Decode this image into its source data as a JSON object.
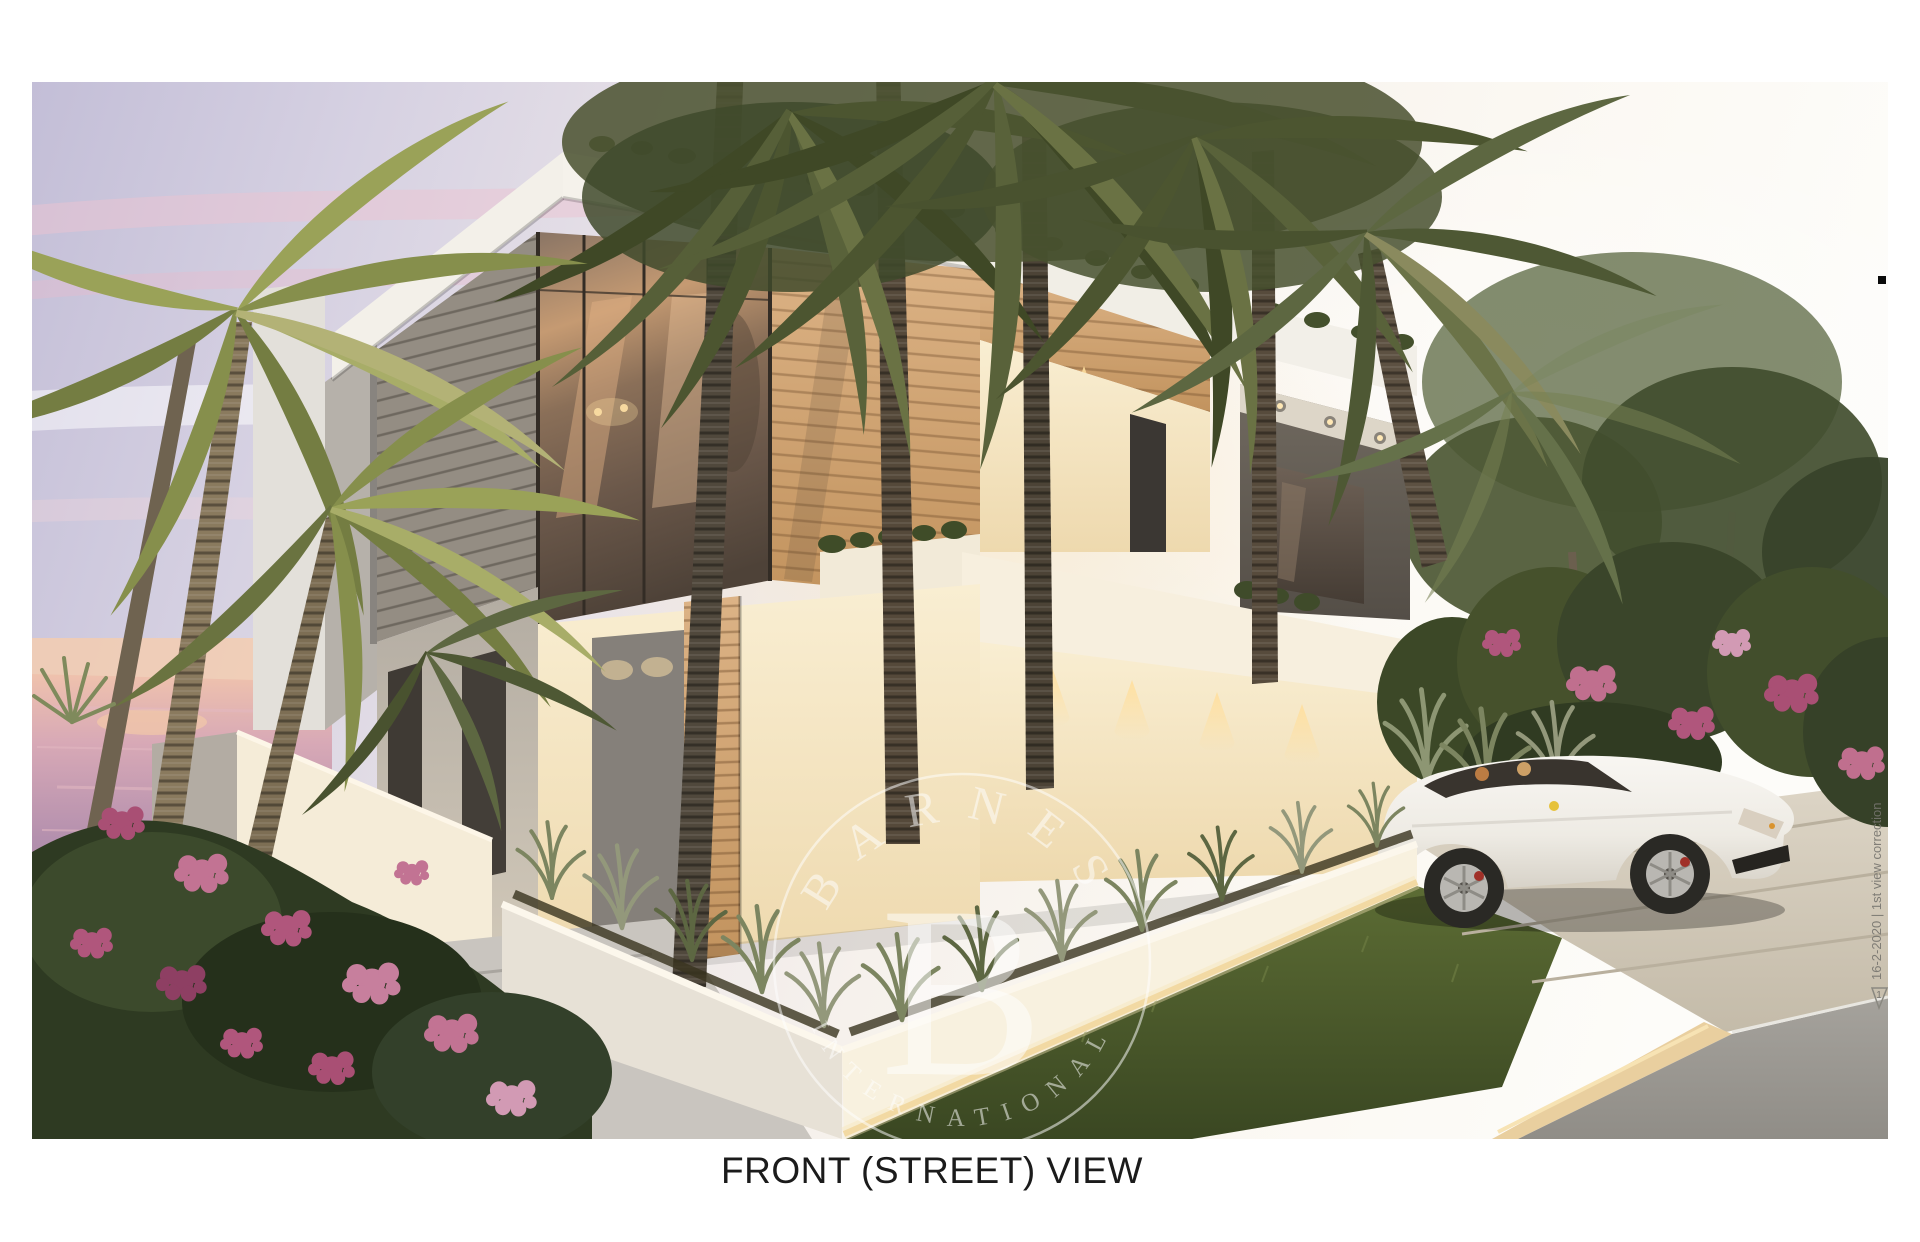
{
  "caption": {
    "text": "FRONT (STREET) VIEW"
  },
  "watermark": {
    "arc_top": "BARNES",
    "initial": "B",
    "arc_bottom": "INTERNATIONAL",
    "color": "#ffffff"
  },
  "revision_note": {
    "text": "16-2-2020 | 1st view correction",
    "marker": "1"
  },
  "palette": {
    "sky_lavender": "#c3bed7",
    "sky_pink": "#ecc3d2",
    "sky_cream": "#fbf8f2",
    "sea_mauve": "#b490ae",
    "horizon_glow": "#f3cdb0",
    "wall_cream": "#f6e9cc",
    "wood_cladding": "#d2a877",
    "foliage_dark": "#49522e",
    "flower_magenta": "#b0567c",
    "driveway": "#d6cec0",
    "asphalt": "#999690",
    "car_white": "#f3f1ec",
    "caption_black": "#1b1b1b",
    "note_gray": "#77756f"
  }
}
